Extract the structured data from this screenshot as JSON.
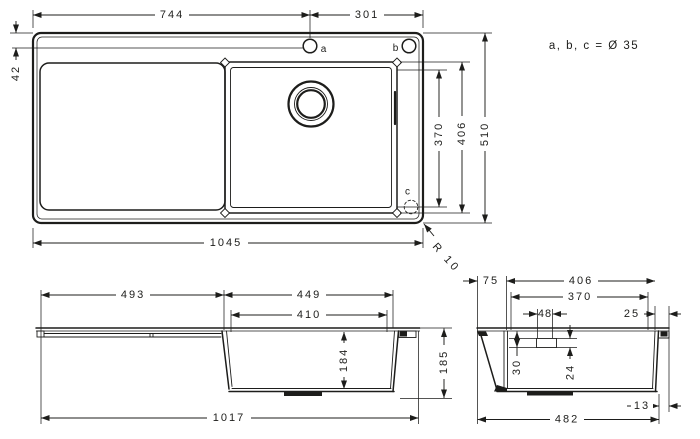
{
  "annotation": {
    "holes_note": "a, b, c = Ø 35"
  },
  "hole_labels": {
    "a": "a",
    "b": "b",
    "c": "c"
  },
  "top_view": {
    "dim_left_to_hole_a": "744",
    "dim_hole_a_to_right": "301",
    "dim_top_edge_to_holes": "42",
    "dim_bowl_inner_depth": "370",
    "dim_bowl_outer_depth": "406",
    "dim_overall_depth": "510",
    "dim_overall_width": "1045",
    "corner_radius": "R 10"
  },
  "side_view": {
    "dim_drainer_length": "493",
    "dim_bowl_top_length": "449",
    "dim_bowl_bottom_length": "410",
    "dim_bowl_depth": "184",
    "dim_overall_height": "185",
    "dim_overall_length": "1017"
  },
  "section_view": {
    "dim_left_rim": "75",
    "dim_bowl_top_width": "406",
    "dim_bowl_bottom_width": "370",
    "dim_drain_width": "48",
    "dim_right_rim": "25",
    "dim_drain_depth": "30",
    "dim_drain_height": "24",
    "dim_base_inset": "13",
    "dim_overall_width": "482"
  }
}
